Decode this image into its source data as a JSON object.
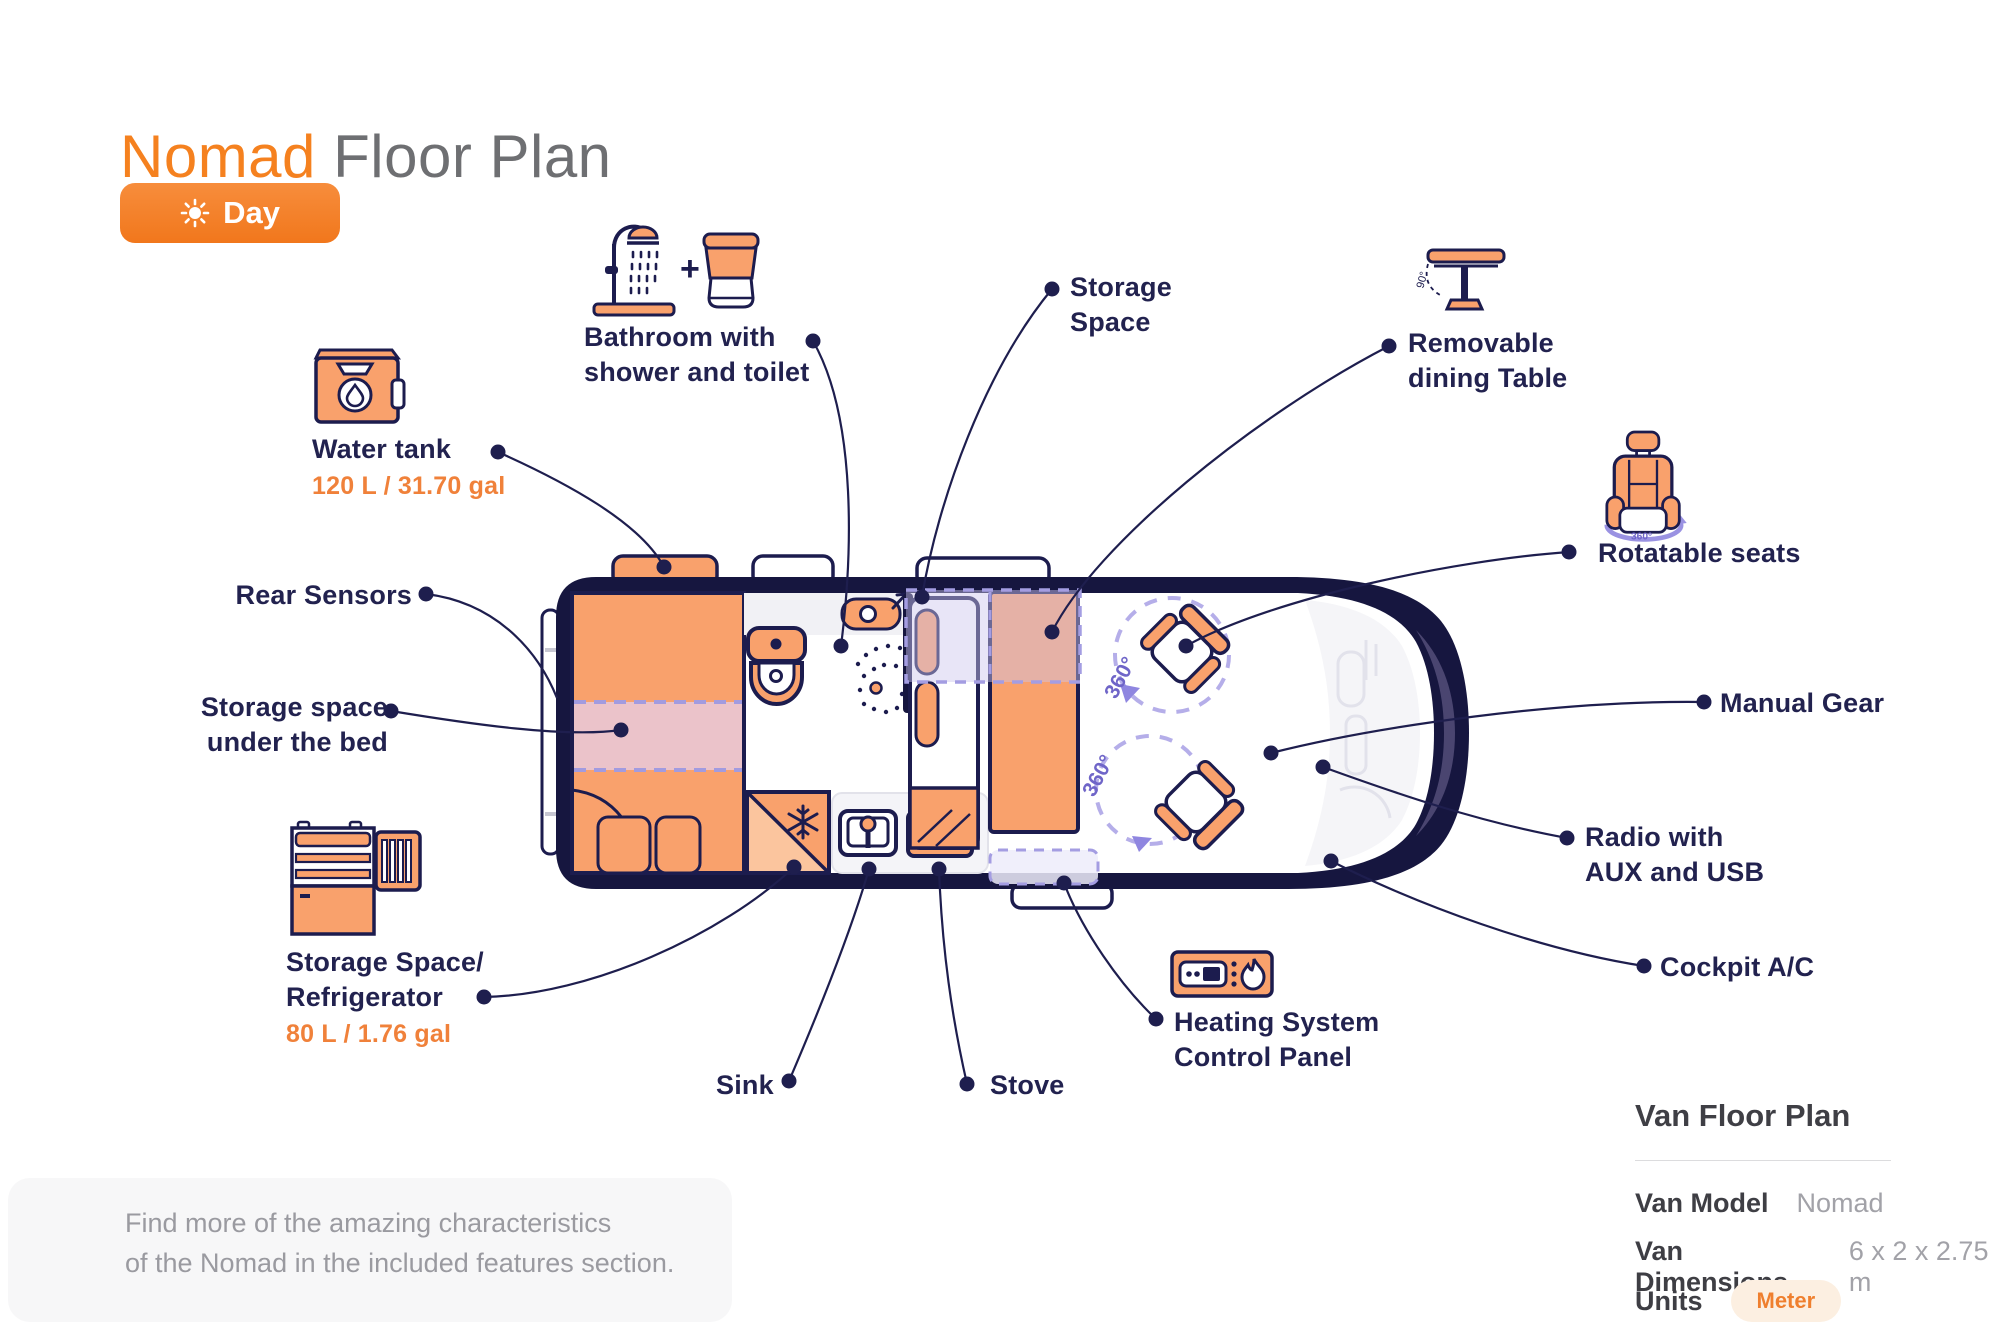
{
  "header": {
    "title_accent": "Nomad",
    "title_rest": "Floor Plan",
    "mode_button": {
      "label": "Day",
      "icon": "sun-icon"
    }
  },
  "callouts": [
    {
      "id": "bathroom",
      "lines": [
        "Bathroom with",
        "shower and toilet"
      ],
      "icon": "shower-toilet-icon"
    },
    {
      "id": "storage-space",
      "lines": [
        "Storage",
        "Space"
      ]
    },
    {
      "id": "dining-table",
      "lines": [
        "Removable",
        "dining Table"
      ],
      "icon": "dining-table-icon"
    },
    {
      "id": "water-tank",
      "lines": [
        "Water tank"
      ],
      "value": "120 L / 31.70 gal",
      "icon": "water-tank-icon"
    },
    {
      "id": "rear-sensors",
      "lines": [
        "Rear Sensors"
      ]
    },
    {
      "id": "storage-under-bed",
      "lines": [
        "Storage space",
        "under the bed"
      ]
    },
    {
      "id": "storage-refrigerator",
      "lines": [
        "Storage Space/",
        "Refrigerator"
      ],
      "value": "80 L / 1.76 gal",
      "icon": "refrigerator-icon"
    },
    {
      "id": "sink",
      "lines": [
        "Sink"
      ]
    },
    {
      "id": "stove",
      "lines": [
        "Stove"
      ]
    },
    {
      "id": "heating",
      "lines": [
        "Heating System",
        "Control Panel"
      ],
      "icon": "heating-panel-icon"
    },
    {
      "id": "rotatable-seats",
      "lines": [
        "Rotatable seats"
      ],
      "icon": "rotatable-seat-icon"
    },
    {
      "id": "manual-gear",
      "lines": [
        "Manual Gear"
      ]
    },
    {
      "id": "radio",
      "lines": [
        "Radio with",
        "AUX and USB"
      ]
    },
    {
      "id": "cockpit-ac",
      "lines": [
        "Cockpit A/C"
      ]
    }
  ],
  "floor_plan": {
    "rotation_labels": [
      "360°",
      "360°"
    ],
    "seat_icon_label": "360°",
    "table_angle_label": "90°",
    "plus_label": "+"
  },
  "note": {
    "line1": "Find more of the amazing characteristics",
    "line2": "of the Nomad in the included features section."
  },
  "info_panel": {
    "title": "Van Floor Plan",
    "rows": [
      {
        "label": "Van Model",
        "value": "Nomad"
      },
      {
        "label": "Van Dimensions",
        "value": "6 x 2 x 2.75 m"
      },
      {
        "label": "Units",
        "value": "Meter"
      }
    ]
  },
  "colors": {
    "accent": "#f5811f",
    "navy": "#1c1c4e",
    "furniture_orange": "#f9a16c",
    "lavender": "#a49de2",
    "gray_text": "#9a9aa0"
  }
}
